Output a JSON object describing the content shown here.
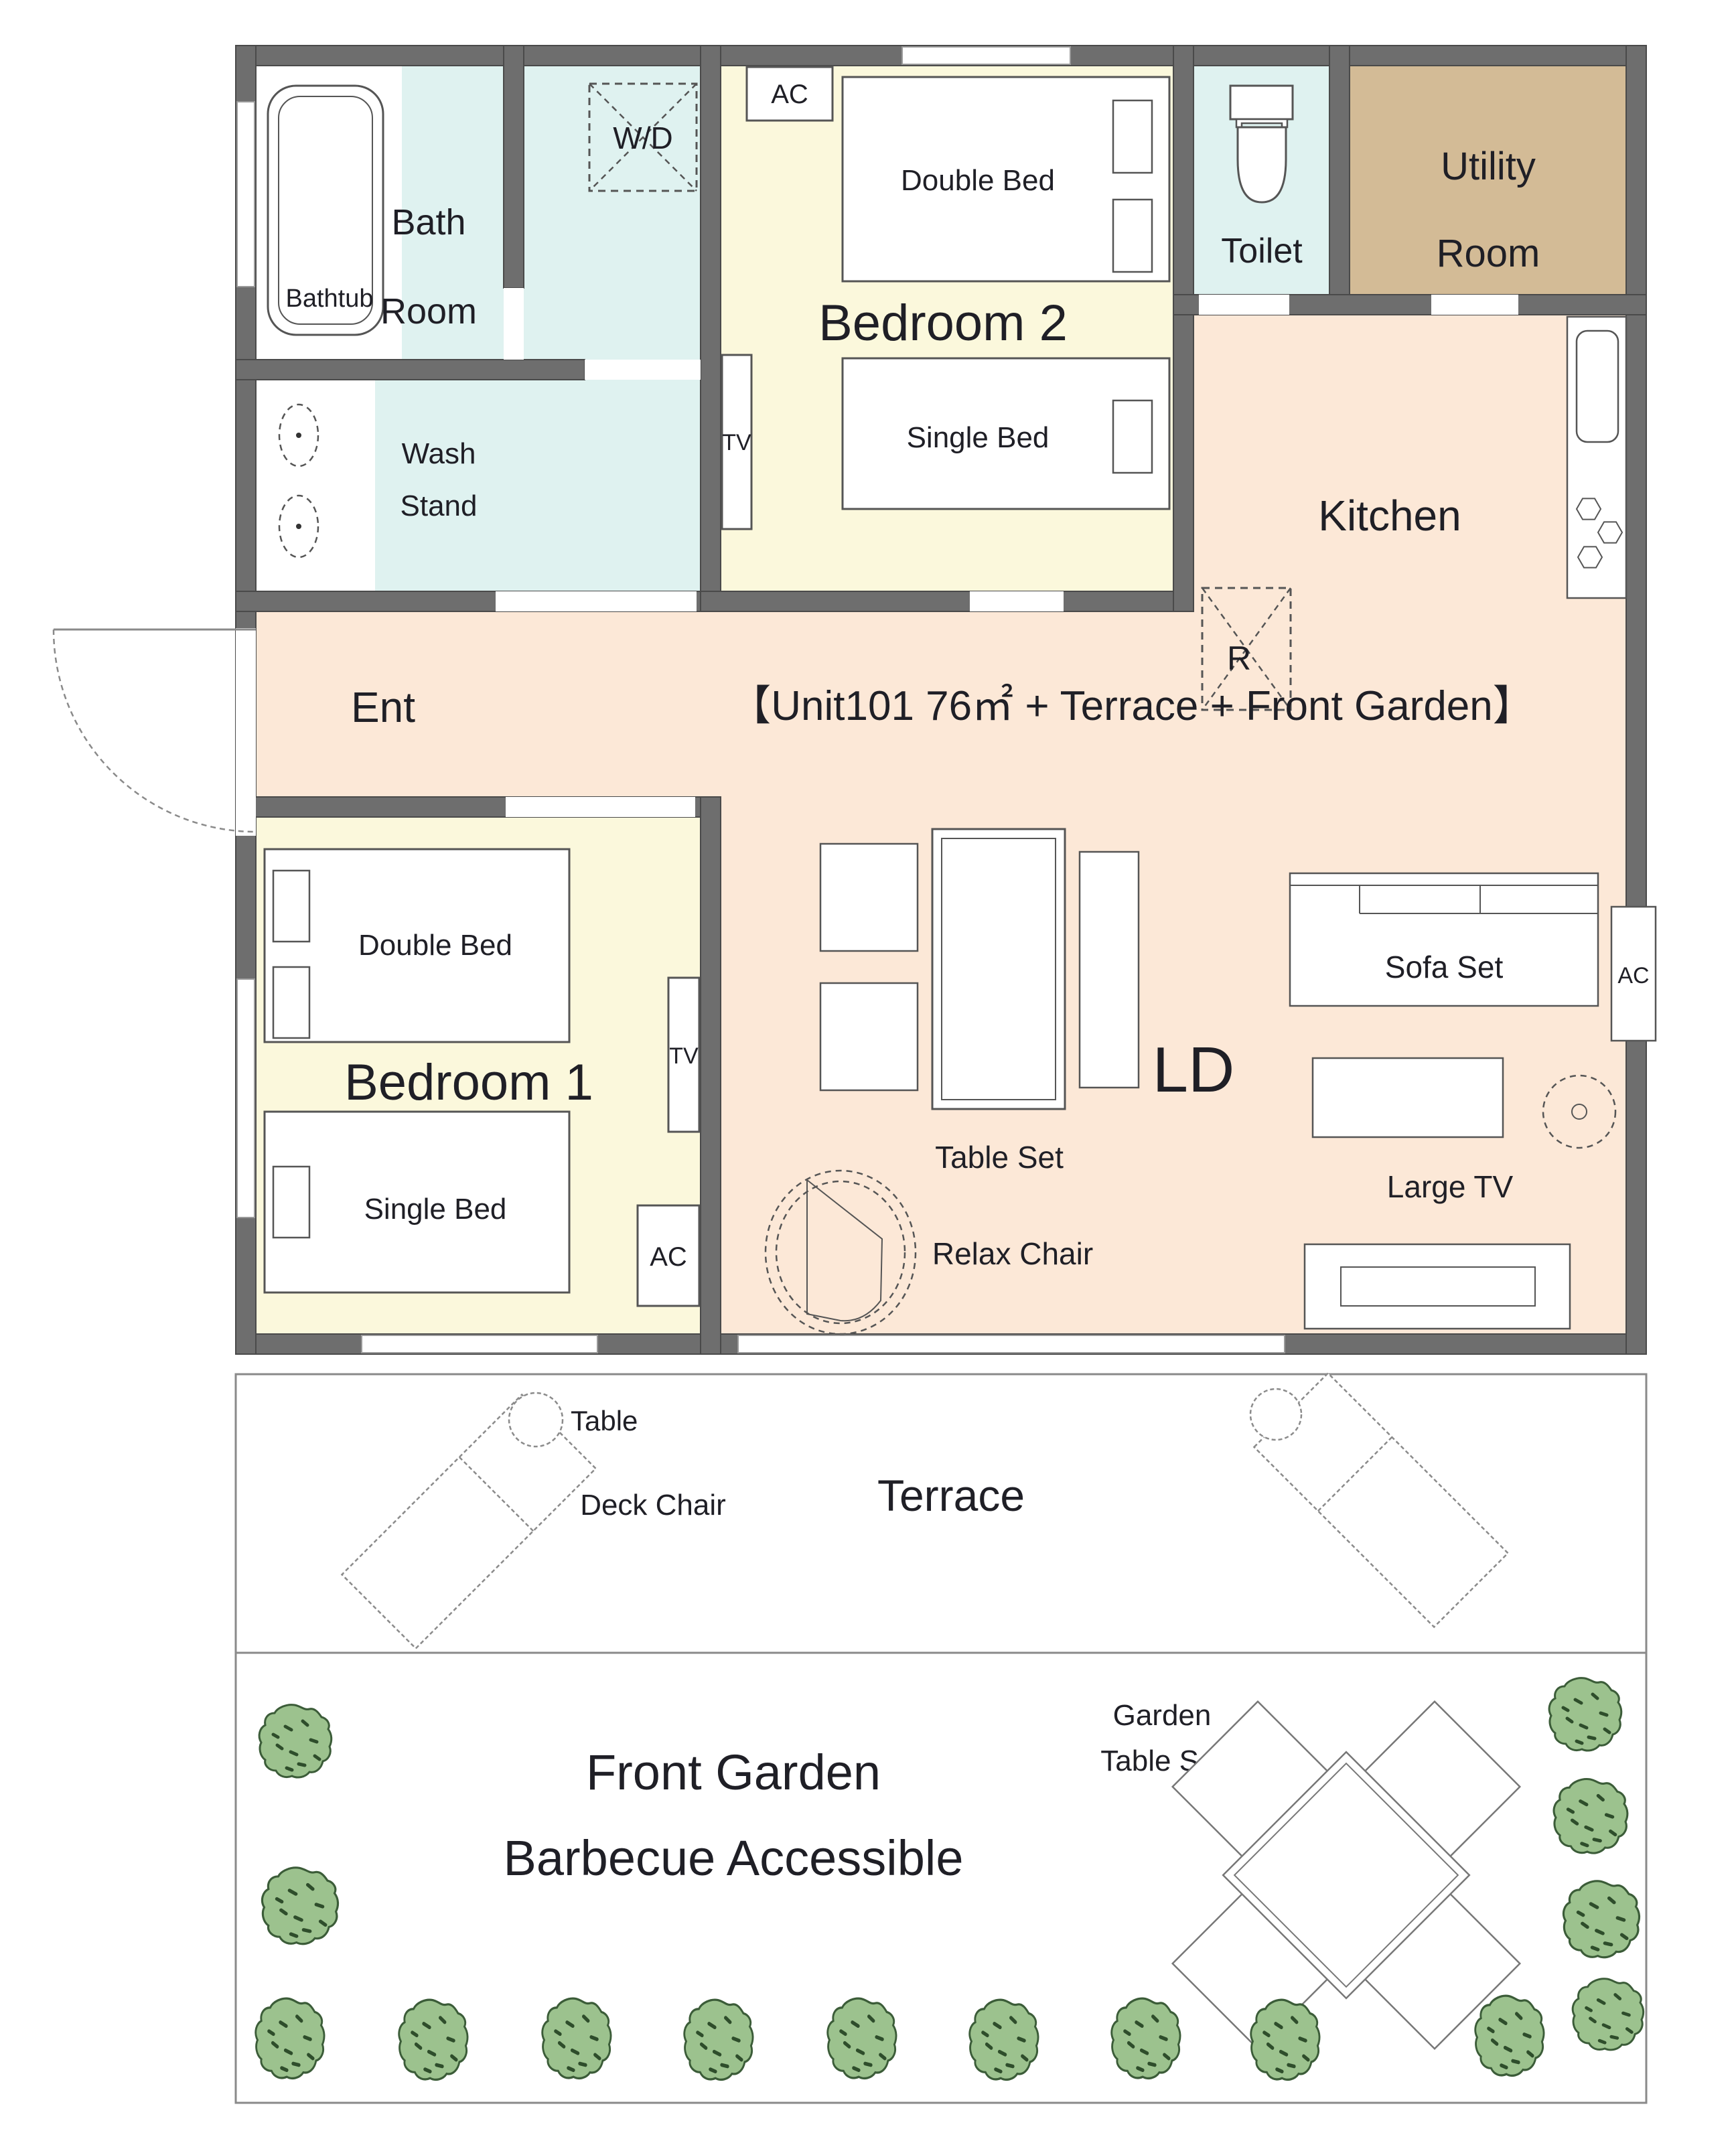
{
  "unit_title": "【Unit101 76㎡ + Terrace + Front Garden】",
  "rooms": {
    "bath": {
      "line1": "Bath",
      "line2": "Room",
      "bathtub": "Bathtub",
      "washer": "W/D"
    },
    "wash_stand": {
      "line1": "Wash",
      "line2": "Stand"
    },
    "bedroom2": {
      "name": "Bedroom 2",
      "double_bed": "Double Bed",
      "single_bed": "Single Bed",
      "ac": "AC",
      "tv": "TV"
    },
    "toilet": {
      "name": "Toilet"
    },
    "utility": {
      "line1": "Utility",
      "line2": "Room"
    },
    "kitchen": {
      "name": "Kitchen",
      "fridge": "R"
    },
    "entrance": {
      "name": "Ent"
    },
    "bedroom1": {
      "name": "Bedroom 1",
      "double_bed": "Double Bed",
      "single_bed": "Single Bed",
      "ac": "AC",
      "tv": "TV"
    },
    "living": {
      "name": "LD",
      "table_set": "Table Set",
      "sofa": "Sofa Set",
      "ac": "AC",
      "relax_chair": "Relax Chair",
      "large_tv": "Large TV"
    },
    "terrace": {
      "name": "Terrace",
      "table": "Table",
      "deck_chair": "Deck Chair"
    },
    "garden": {
      "name": "Front Garden",
      "subtitle": "Barbecue Accessible",
      "table_line1": "Garden",
      "table_line2": "Table Set"
    }
  },
  "colors": {
    "wall": "#6e6e6e",
    "floor": "#fce8d7",
    "bedroom_floor": "#fbf8dc",
    "wet_room_floor": "#dff2f0",
    "utility_floor": "#d3bb96",
    "bush_green": "#9cc28e",
    "outdoor": "#ffffff"
  }
}
